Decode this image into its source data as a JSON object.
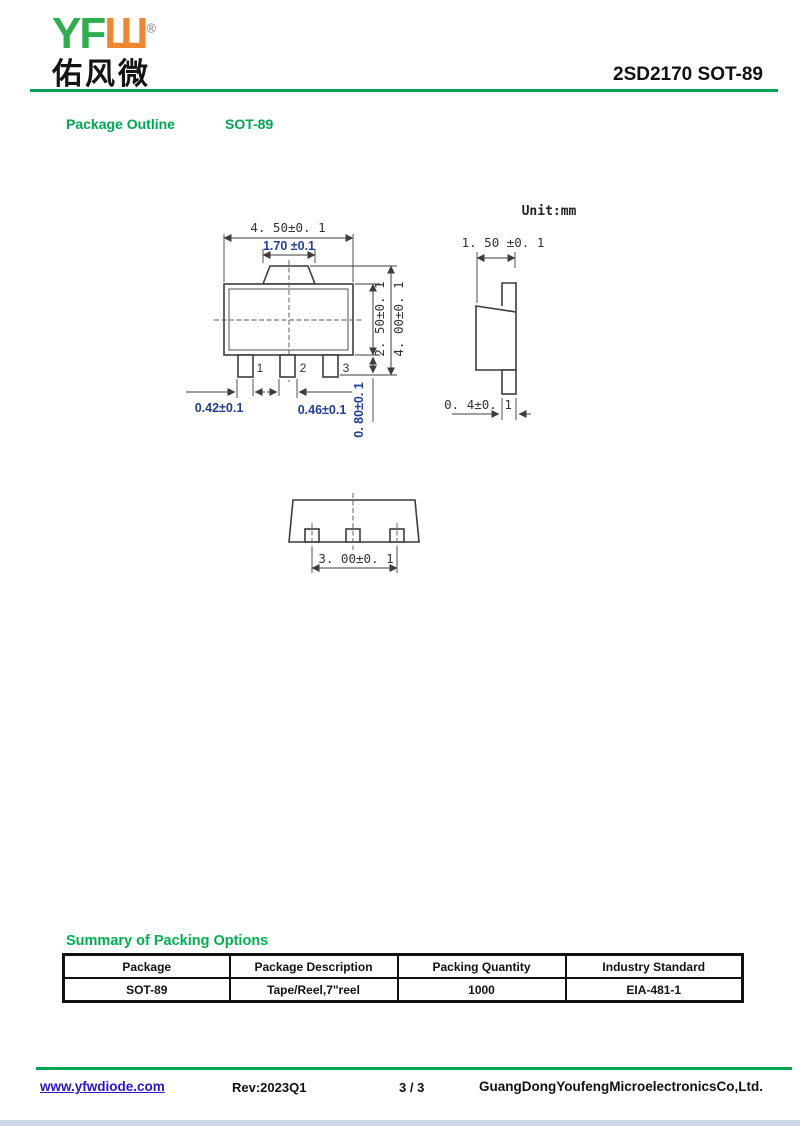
{
  "header": {
    "logo_en_green": "YF",
    "logo_en_orange": "Ш",
    "registered_mark": "®",
    "logo_chinese": "佑风微",
    "title": "2SD2170 SOT-89"
  },
  "section": {
    "label": "Package Outline",
    "package": "SOT-89"
  },
  "drawing": {
    "unit_label": "Unit:mm",
    "front_view": {
      "dim_body_width": "4. 50±0. 1",
      "dim_tab_width": "1.70 ±0.1",
      "dim_body_height": "2. 50±0. 1",
      "dim_total_height": "4. 00±0. 1",
      "dim_pin_width": "0.42±0.1",
      "dim_center_pin_width": "0.46±0.1",
      "dim_pin_length": "0. 80±0. 1",
      "pin_numbers": [
        "1",
        "2",
        "3"
      ]
    },
    "side_view": {
      "dim_thickness": "1. 50 ±0. 1",
      "dim_pin_thickness": "0. 4±0. 1"
    },
    "bottom_view": {
      "dim_outer_pin_pitch": "3. 00±0. 1"
    }
  },
  "packing": {
    "heading": "Summary of Packing Options",
    "columns": [
      "Package",
      "Package Description",
      "Packing Quantity",
      "Industry Standard"
    ],
    "rows": [
      [
        "SOT-89",
        "Tape/Reel,7\"reel",
        "1000",
        "EIA-481-1"
      ]
    ]
  },
  "footer": {
    "website": "www.yfwdiode.com",
    "revision": "Rev:2023Q1",
    "page_number": "3 / 3",
    "company": "GuangDongYoufengMicroelectronicsCo,Ltd."
  },
  "colors": {
    "brand_green": "#00a651",
    "logo_green": "#2fae4f",
    "logo_orange": "#ef8632",
    "dimension_blue": "#1f3f94",
    "link_blue": "#2a16c7",
    "drawing_line": "#3d3d3d",
    "bottom_bar_blue": "#ccd8ea"
  }
}
